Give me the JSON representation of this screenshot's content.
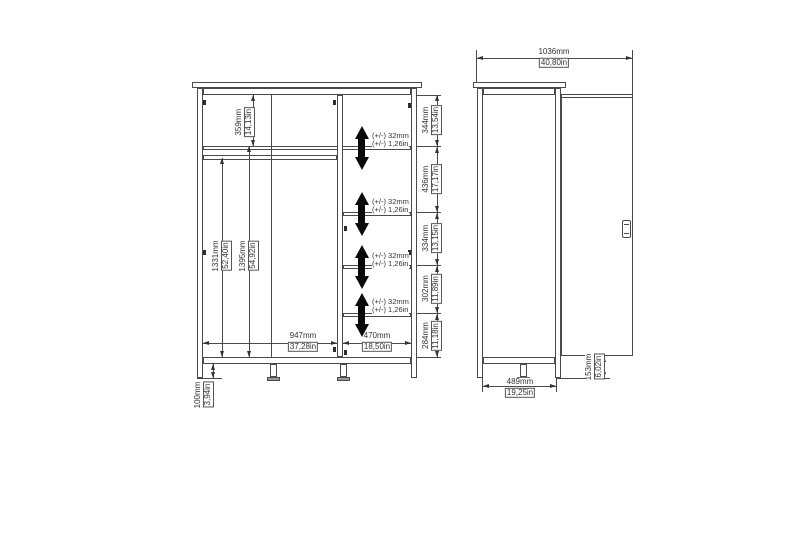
{
  "front": {
    "top_shelf_height": {
      "mm": "359mm",
      "in": "14,13in"
    },
    "hang_height": {
      "mm": "1331mm",
      "in": "52,40in"
    },
    "left_inner_height": {
      "mm": "1395mm",
      "in": "54,92in"
    },
    "left_width": {
      "mm": "947mm",
      "in": "37,28in"
    },
    "right_width": {
      "mm": "470mm",
      "in": "18,50in"
    },
    "leg_height": {
      "mm": "100mm",
      "in": "3,94in"
    },
    "chain": [
      {
        "mm": "344mm",
        "in": "13,54in"
      },
      {
        "mm": "436mm",
        "in": "17,17in"
      },
      {
        "mm": "334mm",
        "in": "13,15in"
      },
      {
        "mm": "302mm",
        "in": "11,89in"
      },
      {
        "mm": "284mm",
        "in": "11,18in"
      }
    ],
    "adjust": {
      "l1": "(+/-) 32mm",
      "l2": "(+/-) 1,26in"
    }
  },
  "side": {
    "total_depth": {
      "mm": "1036mm",
      "in": "40,80in"
    },
    "body_depth": {
      "mm": "489mm",
      "in": "19,25in"
    },
    "door_gap": {
      "mm": "153mm",
      "in": "6,02in"
    }
  }
}
